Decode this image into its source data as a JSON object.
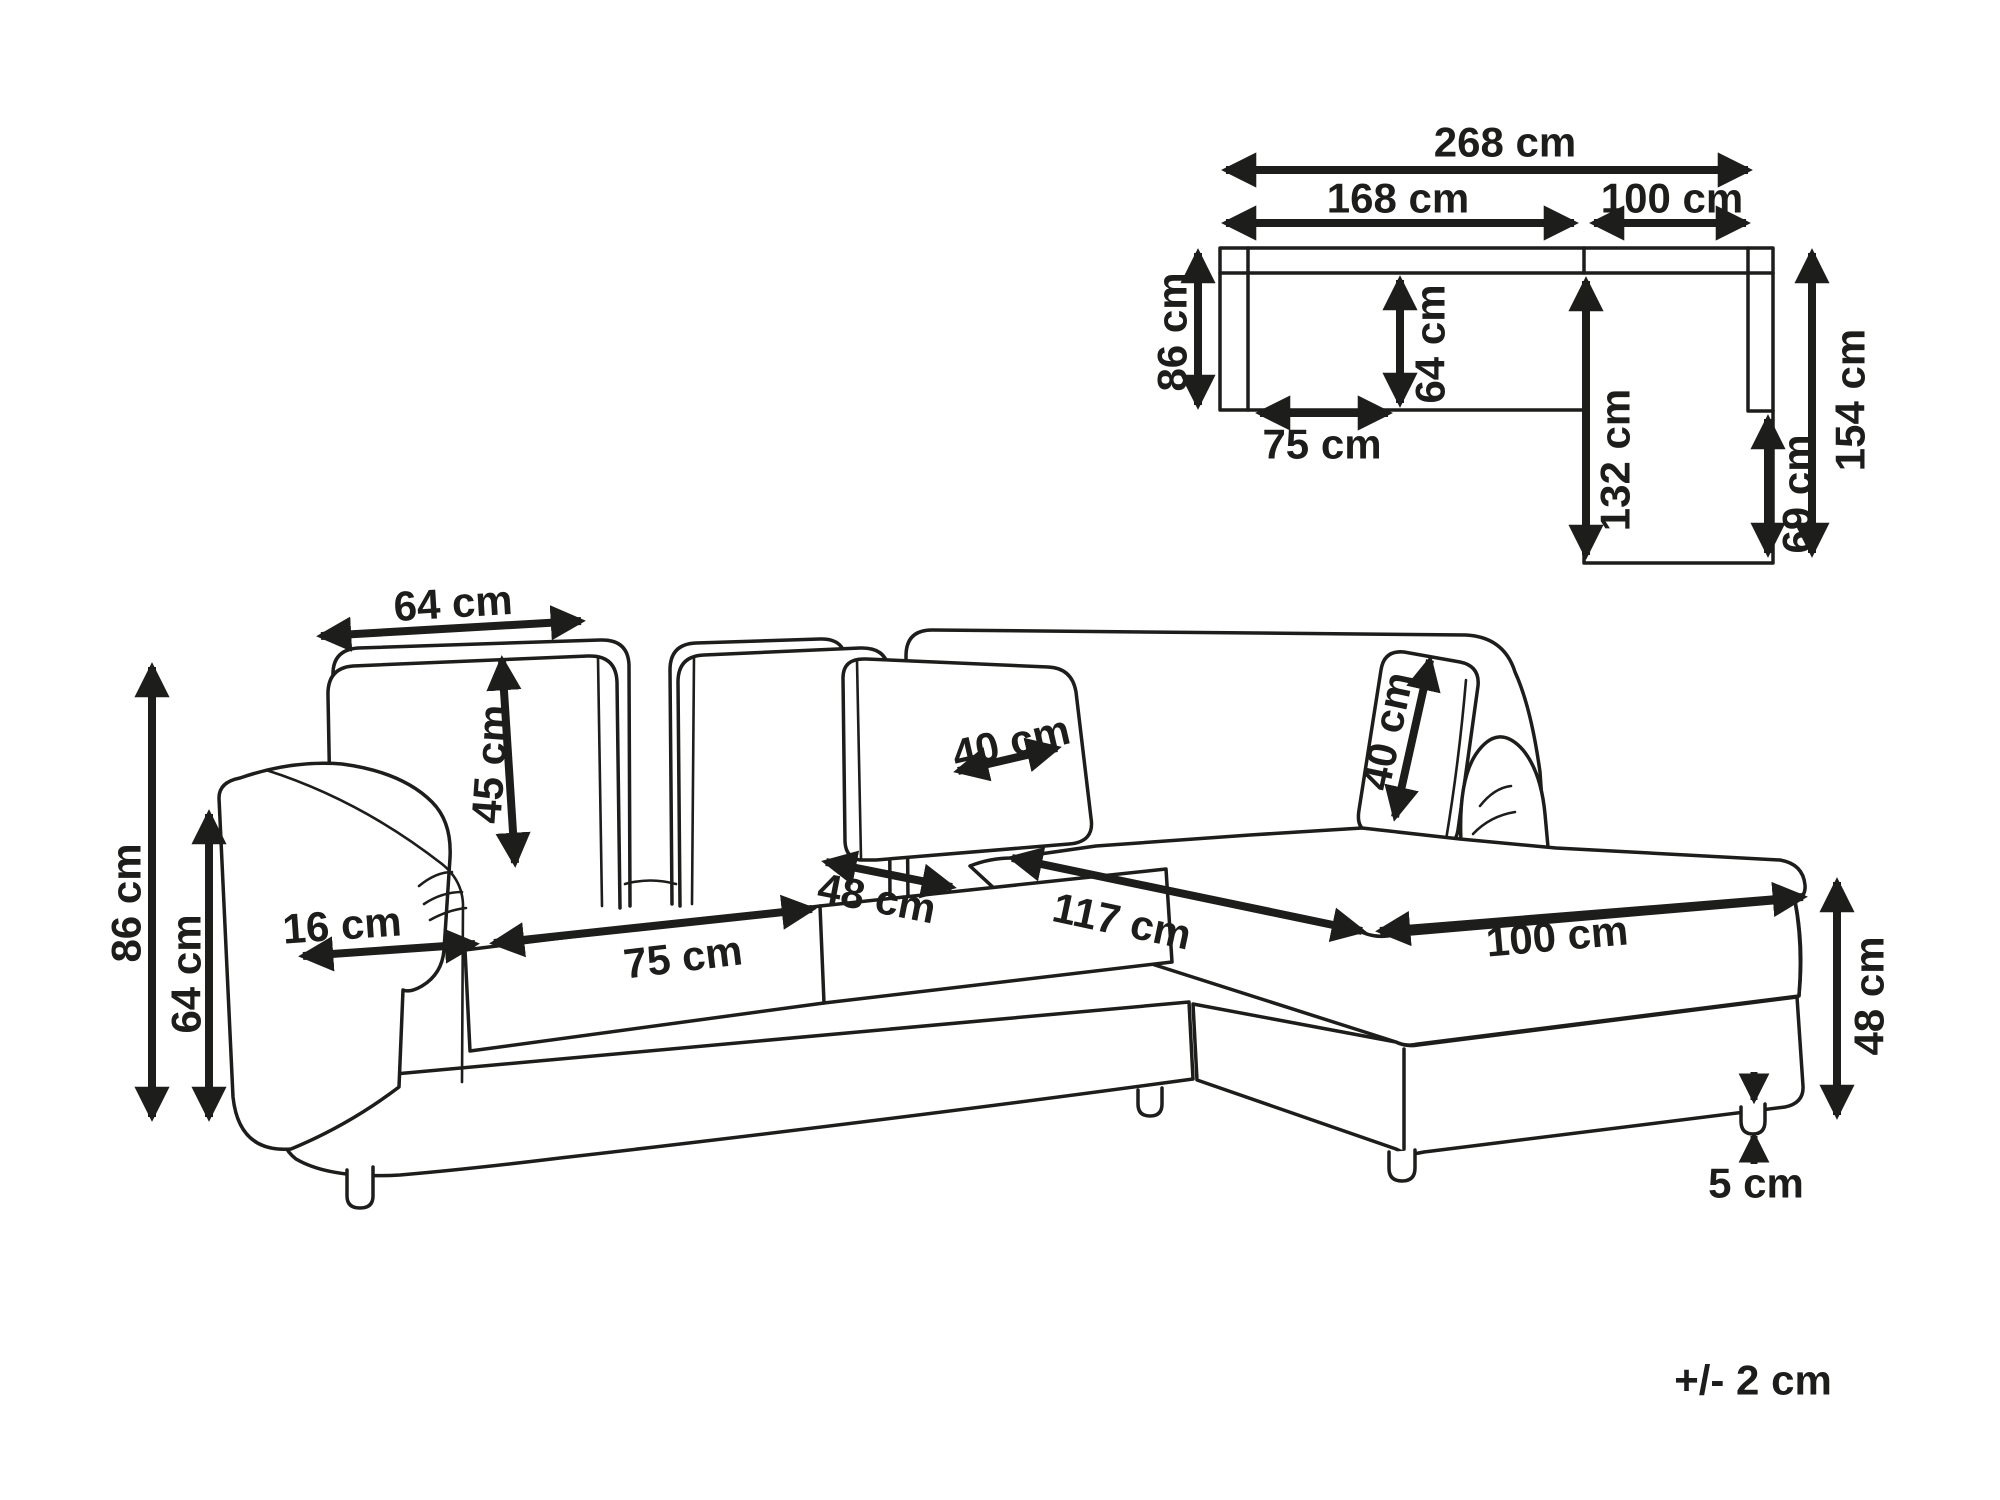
{
  "title": "Corner sofa dimension diagram",
  "tolerance_note": "+/- 2 cm",
  "unit": "cm",
  "colors": {
    "line": "#1d1d1b",
    "background": "#ffffff"
  },
  "plan_view": {
    "total_width": "268 cm",
    "left_section_width": "168 cm",
    "chaise_section_width": "100 cm",
    "body_depth": "86 cm",
    "inner_seat_depth": "64 cm",
    "seat_width": "75 cm",
    "chaise_inner_length": "132 cm",
    "chaise_extension": "69 cm",
    "chaise_total_length": "154 cm"
  },
  "perspective_view": {
    "back_cushion_width": "64 cm",
    "back_cushion_height": "45 cm",
    "total_height": "86 cm",
    "armrest_height": "64 cm",
    "armrest_width": "16 cm",
    "seat_cushion_width": "75 cm",
    "seat_cushion_depth": "48 cm",
    "corner_cushion_width": "40 cm",
    "side_pillow_width": "40 cm",
    "chaise_seat_length": "117 cm",
    "chaise_seat_width": "100 cm",
    "seat_height": "48 cm",
    "leg_height": "5 cm"
  }
}
